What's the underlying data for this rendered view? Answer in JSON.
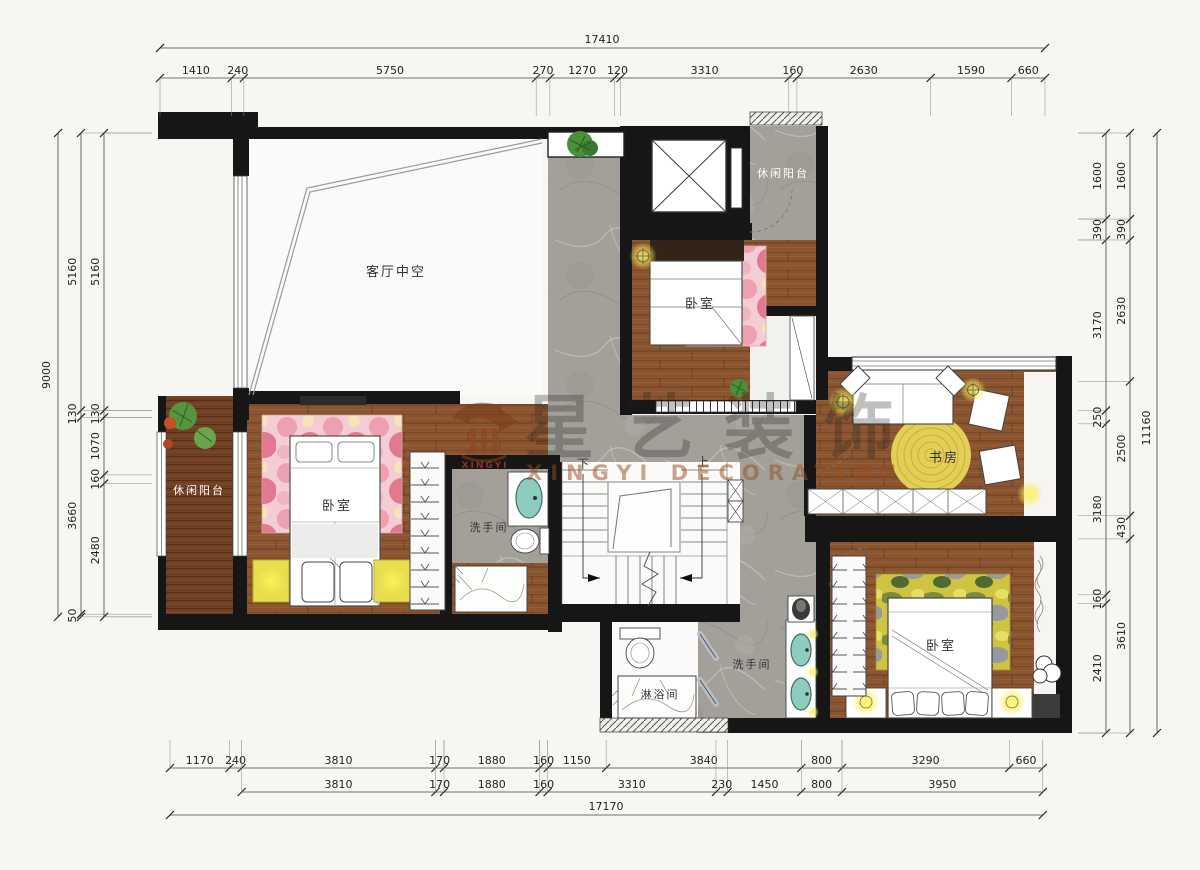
{
  "watermark": {
    "logo_text": "XINGYI",
    "brand_cn": "星艺装饰",
    "brand_en": "XINGYI DECORATION"
  },
  "labels": {
    "living_void": "客厅中空",
    "balcony_top": "休闲阳台",
    "bedroom_top": "卧室",
    "study": "书房",
    "balcony_left": "休闲阳台",
    "bedroom_left": "卧室",
    "bath_mid": "洗手间",
    "shower_room": "淋浴间",
    "bath_bottom": "洗手间",
    "bedroom_bottom": "卧室",
    "stair_down": "下",
    "stair_up": "上"
  },
  "dimensions": {
    "top": {
      "total": "17410",
      "segments": [
        1410,
        240,
        5750,
        270,
        1270,
        120,
        3310,
        160,
        2630,
        1590,
        660
      ]
    },
    "bottom": {
      "total": "17170",
      "row1": [
        1170,
        240,
        3810,
        170,
        1880,
        160,
        1150,
        3840,
        800,
        3290,
        660
      ],
      "row2": [
        3810,
        170,
        1880,
        160,
        3310,
        230,
        1450,
        800,
        3950
      ]
    },
    "left": {
      "total": "9000",
      "outer_chain": [
        5160,
        130,
        3660,
        50
      ],
      "inner_chain": [
        5160,
        130,
        1070,
        160,
        2480
      ]
    },
    "right": {
      "total": "11160",
      "inner_chain": [
        1600,
        390,
        3170,
        250,
        3180,
        160,
        2410
      ],
      "middle_chain": [
        1600,
        390,
        2630,
        2500,
        430,
        3610
      ]
    }
  },
  "colors": {
    "wall": "#161616",
    "wood": "#8a5530",
    "deck": "#6e3f22",
    "marble": "#a4a09a",
    "glow": "#f8ee54",
    "sink": "#8fccc0",
    "rug_pink": "#f3cdd3",
    "rug_camo": "#cfc441"
  }
}
